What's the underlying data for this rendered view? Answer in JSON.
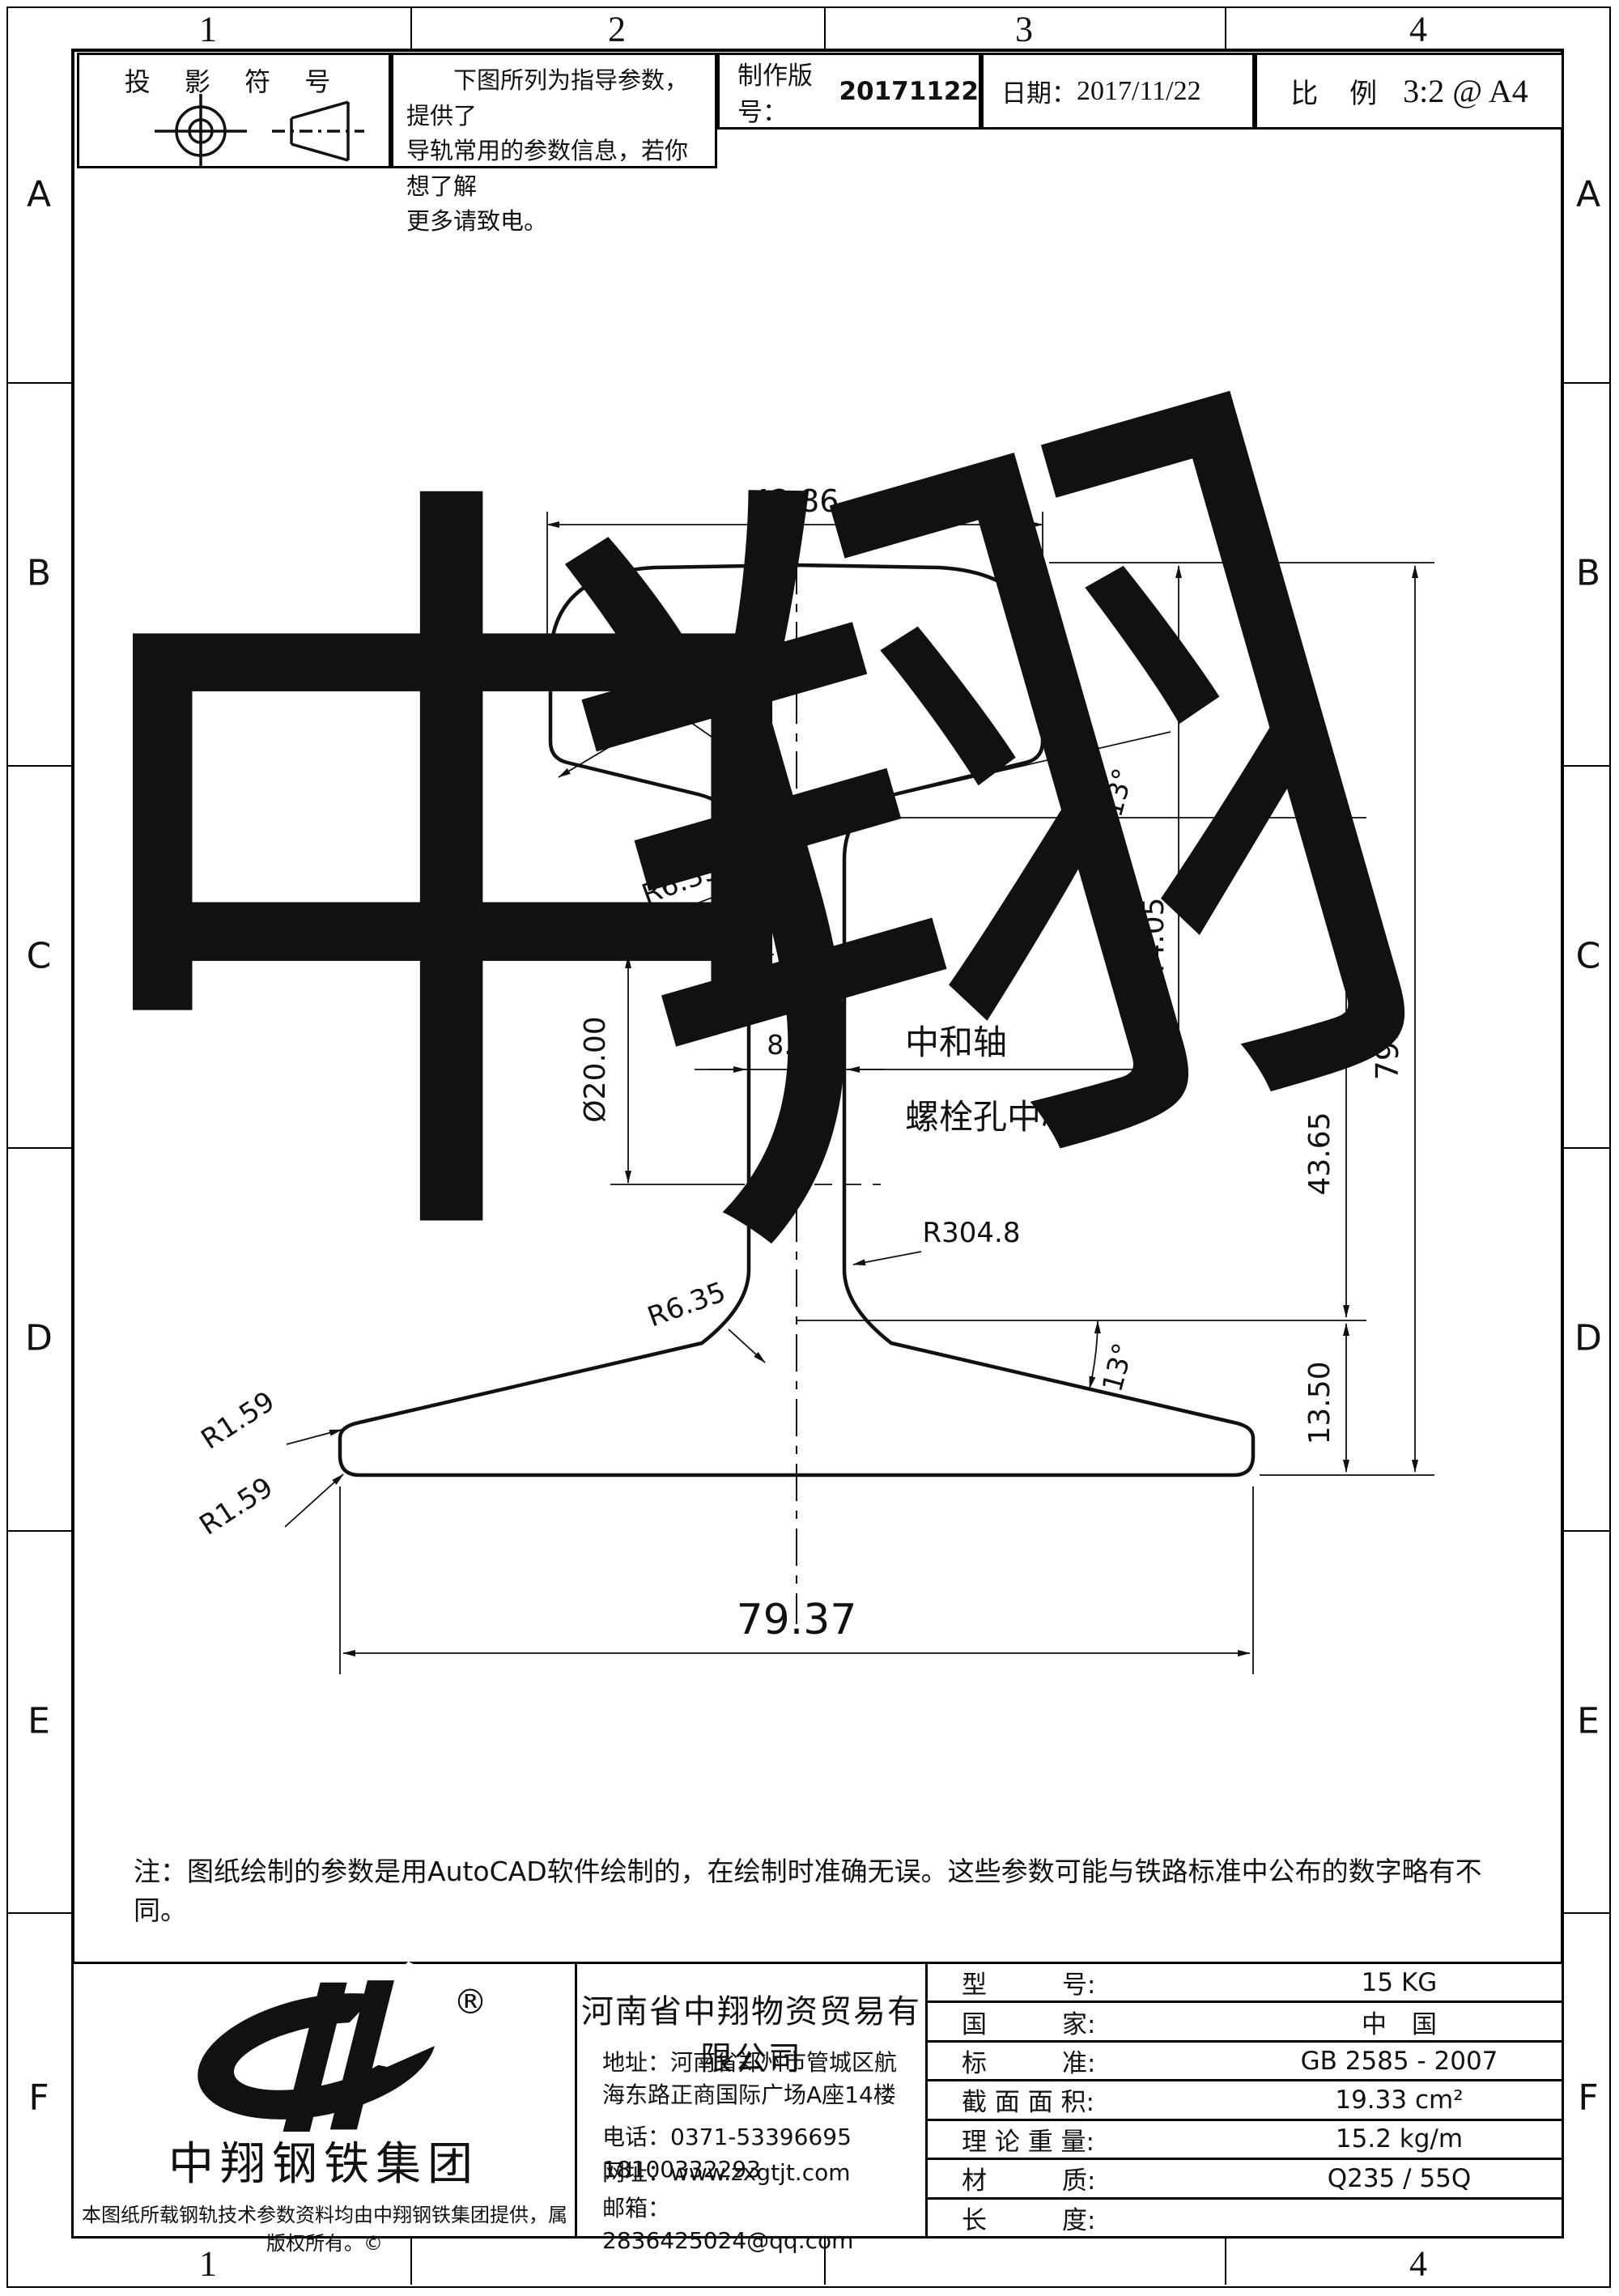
{
  "frame": {
    "cols_top": [
      "1",
      "2",
      "3",
      "4"
    ],
    "cols_bottom": [
      "1",
      "",
      "",
      "4"
    ],
    "rows": [
      "A",
      "B",
      "C",
      "D",
      "E",
      "F"
    ]
  },
  "header": {
    "projection_title": "投 影 符 号",
    "guide_line1": "　　下图所列为指导参数，提供了",
    "guide_line2": "导轨常用的参数信息，若你想了解",
    "guide_line3": "更多请致电。",
    "version_label": "制作版号：",
    "version_value": "20171122",
    "date_label": "日期：",
    "date_value": "2017/11/22",
    "scale_label": "比 例",
    "scale_value": "3:2 @ A4"
  },
  "drawing": {
    "dims": {
      "head_width": "42.86",
      "hole_dia": "Ø20.00",
      "web_thickness": "8.33",
      "top_to_neutral": "44.05",
      "web_zone": "43.65",
      "foot_zone": "13.50",
      "total_height": "79.37",
      "foot_width": "79.37",
      "angle_head": "13°",
      "angle_foot": "13°",
      "r_head_top": "R7.94",
      "r_head_side": "R1.59",
      "r_web_top": "R6.35",
      "r_web_side": "R304.8",
      "r_web_bottom": "R6.35",
      "r_foot_top": "R1.59",
      "r_foot_bottom": "R1.59"
    },
    "labels": {
      "neutral_axis": "中和轴",
      "bolt_hole_centerline": "螺栓孔中心线"
    },
    "watermark1": "中",
    "watermark2": "翔"
  },
  "note": "注：图纸绘制的参数是用AutoCAD软件绘制的，在绘制时准确无误。这些参数可能与铁路标准中公布的数字略有不同。",
  "title_block": {
    "brand": {
      "reg": "®",
      "name": "中翔钢铁集团",
      "copyright": "本图纸所载钢轨技术参数资料均由中翔钢铁集团提供，属版权所有。©"
    },
    "company": {
      "name": "河南省中翔物资贸易有限公司",
      "address": "地址：河南省郑州市管城区航海东路正商国际广场A座14楼",
      "phone": "电话：0371-53396695　18100332293",
      "website": "网址：www.zxgtjt.com",
      "email": "邮箱：2836425024@qq.com"
    },
    "specs": [
      {
        "label": "型　　　号:",
        "value": "15  KG"
      },
      {
        "label": "国　　　家:",
        "value": "中　国"
      },
      {
        "label": "标　　　准:",
        "value": "GB 2585 - 2007"
      },
      {
        "label": "截 面 面 积:",
        "value": "19.33 cm²"
      },
      {
        "label": "理 论 重 量:",
        "value": "15.2 kg/m"
      },
      {
        "label": "材　　　质:",
        "value": "Q235 / 55Q"
      },
      {
        "label": "长　　　度:",
        "value": ""
      }
    ]
  }
}
